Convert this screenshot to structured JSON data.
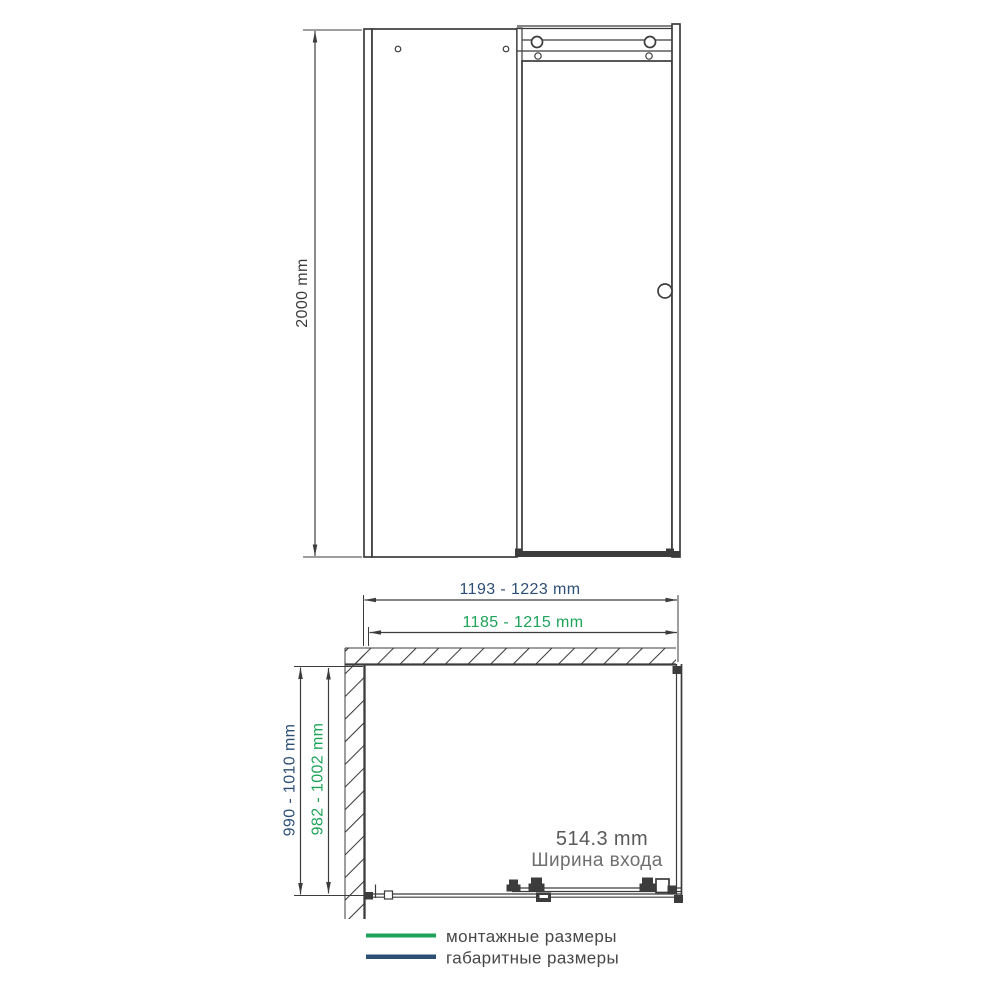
{
  "colors": {
    "mounting_green": "#1ea35a",
    "overall_blue": "#2d4f76",
    "line_dark": "#3c3c3c",
    "text_gray": "#595959",
    "text_gray_light": "#6f6f6f",
    "legend_text": "#474747"
  },
  "front_view": {
    "height_dim": "2000 mm"
  },
  "plan_view": {
    "overall_width_dim": "1193 - 1223 mm",
    "mounting_width_dim": "1185 - 1215 mm",
    "overall_depth_dim": "990 - 1010 mm",
    "mounting_depth_dim": "982 - 1002 mm",
    "entry_width_value": "514.3 mm",
    "entry_width_label": "Ширина входа"
  },
  "legend": {
    "items": [
      {
        "label": "монтажные размеры",
        "type": "mounting"
      },
      {
        "label": "габаритные размеры",
        "type": "overall"
      }
    ]
  }
}
